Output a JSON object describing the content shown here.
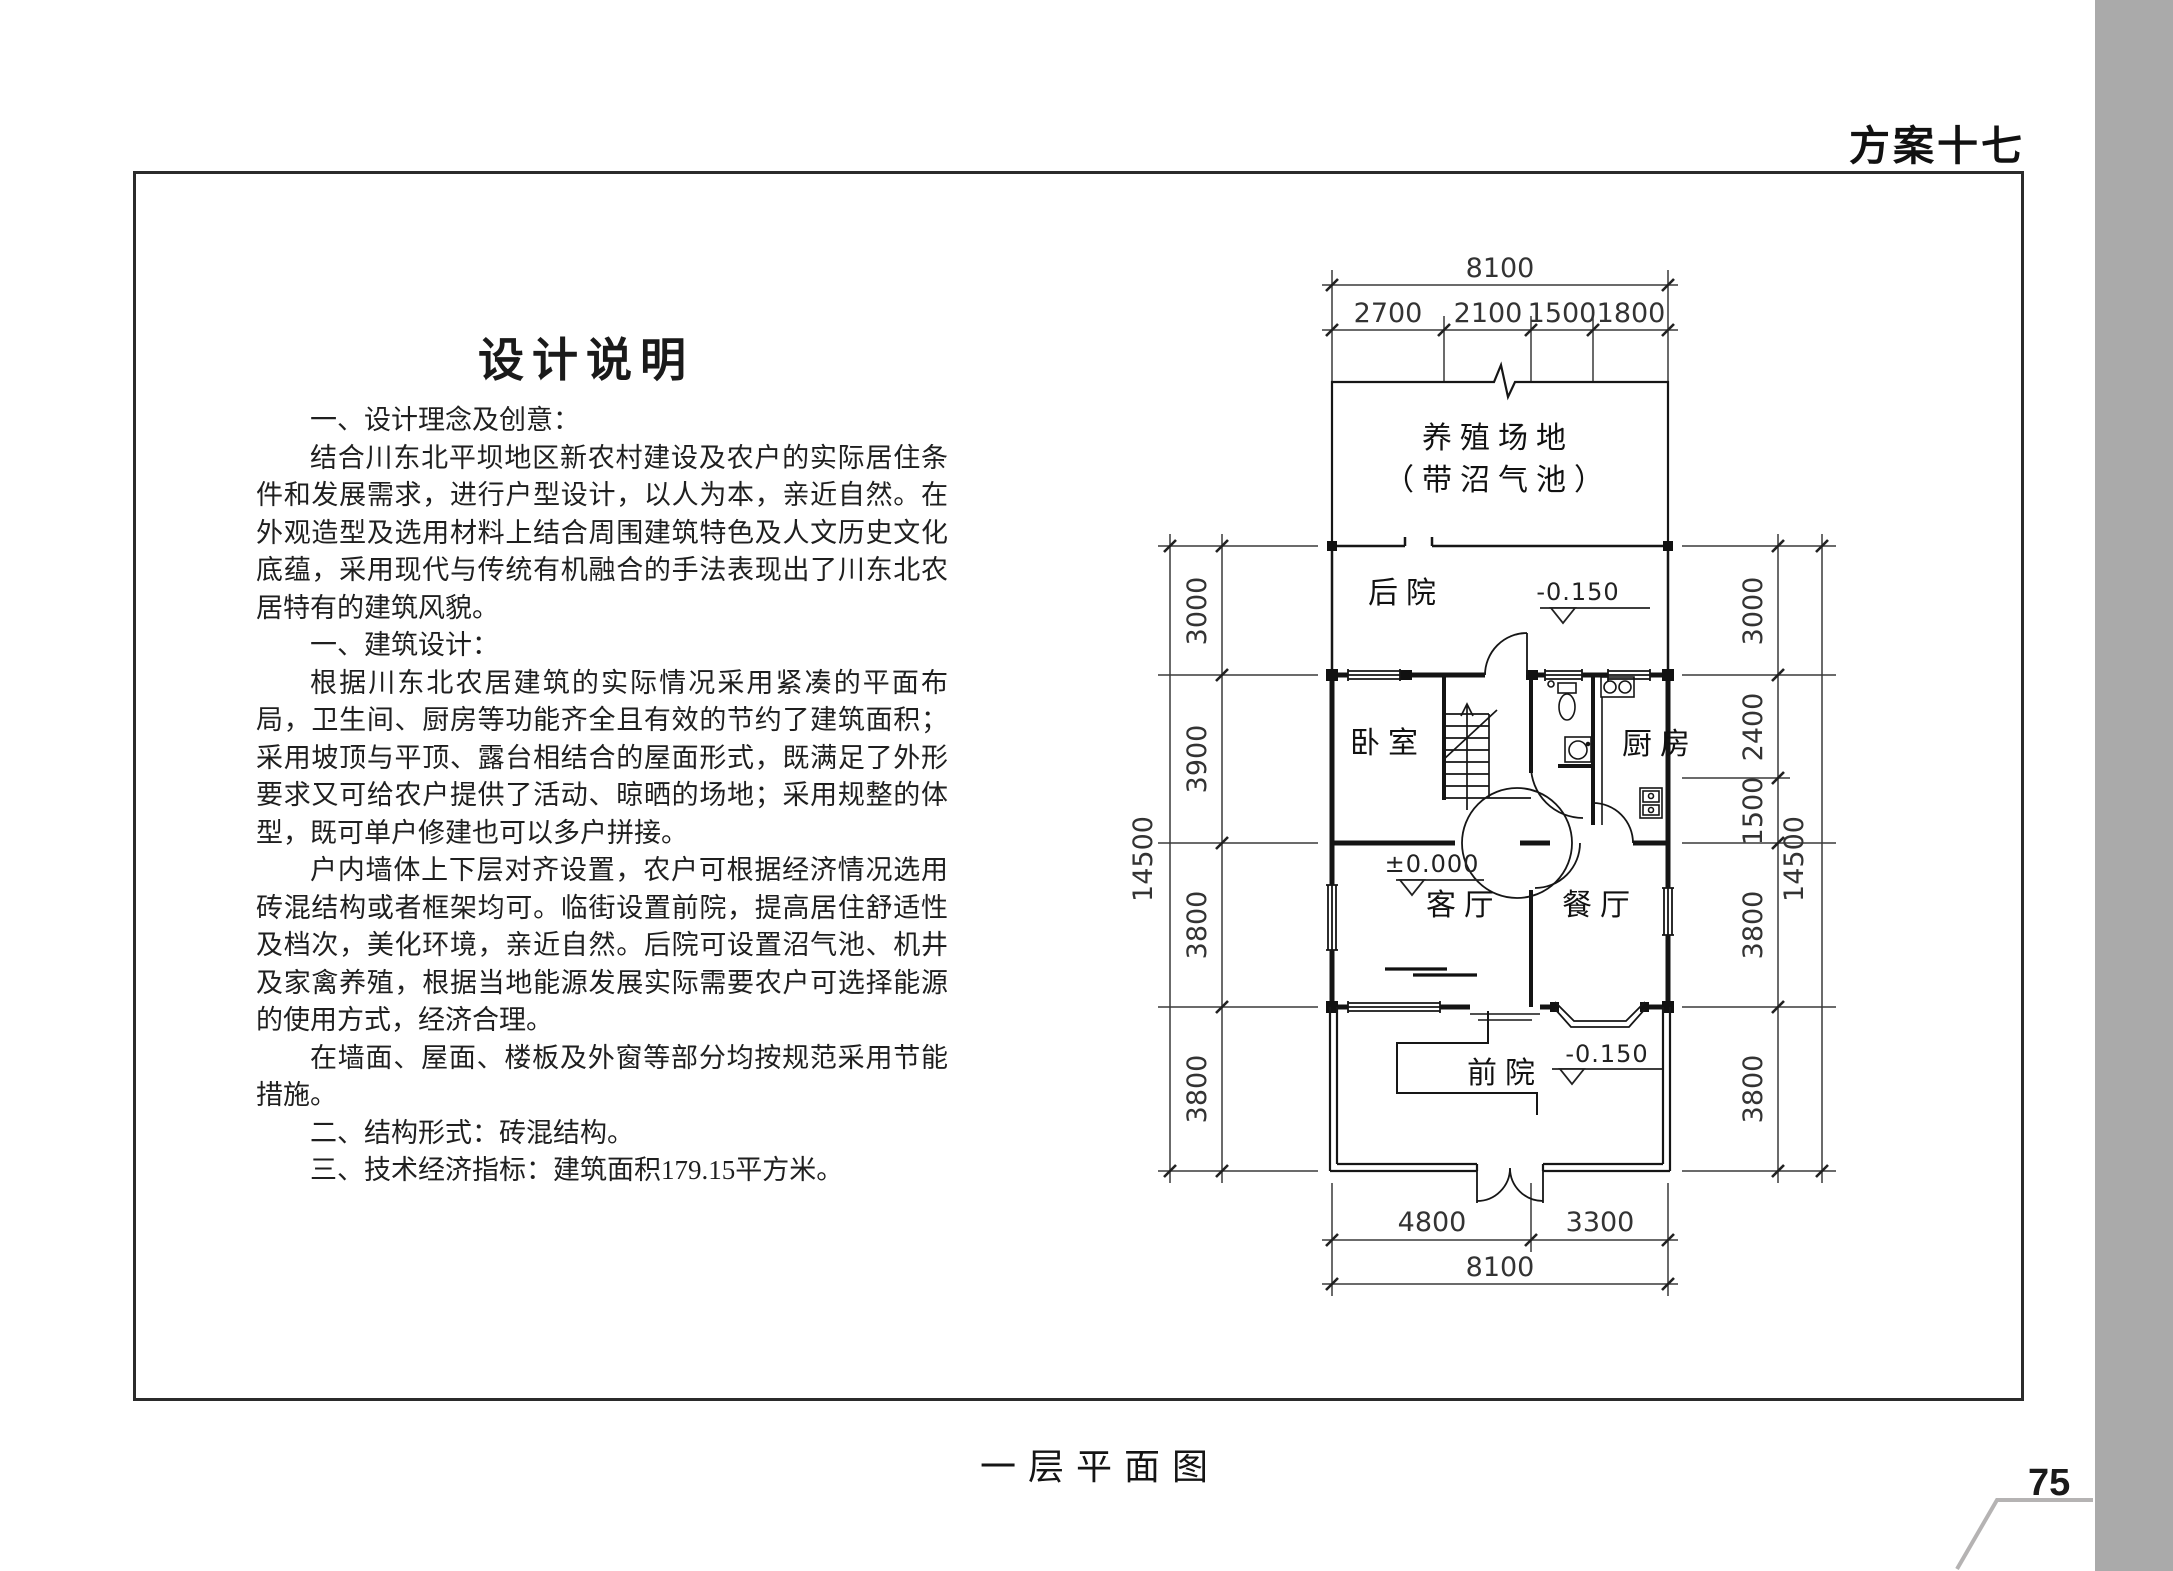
{
  "header": {
    "scheme_label": "方案十七"
  },
  "design_notes": {
    "title": "设计说明",
    "paragraphs": [
      "一、设计理念及创意：",
      "结合川东北平坝地区新农村建设及农户的实际居住条件和发展需求，进行户型设计，以人为本，亲近自然。在外观造型及选用材料上结合周围建筑特色及人文历史文化底蕴，采用现代与传统有机融合的手法表现出了川东北农居特有的建筑风貌。",
      "一、建筑设计：",
      "根据川东北农居建筑的实际情况采用紧凑的平面布局，卫生间、厨房等功能齐全且有效的节约了建筑面积；采用坡顶与平顶、露台相结合的屋面形式，既满足了外形要求又可给农户提供了活动、晾晒的场地；采用规整的体型，既可单户修建也可以多户拼接。",
      "户内墙体上下层对齐设置，农户可根据经济情况选用砖混结构或者框架均可。临街设置前院，提高居住舒适性及档次，美化环境，亲近自然。后院可设置沼气池、机井及家禽养殖，根据当地能源发展实际需要农户可选择能源的使用方式，经济合理。",
      "在墙面、屋面、楼板及外窗等部分均按规范采用节能措施。",
      "二、结构形式：砖混结构。",
      "三、技术经济指标：建筑面积179.15平方米。"
    ]
  },
  "floor_plan": {
    "caption": "一层平面图",
    "rooms": {
      "breeding_area": "养殖场地",
      "breeding_area_sub": "（带沼气池）",
      "backyard": "后院",
      "bedroom": "卧室",
      "kitchen": "厨房",
      "living_room": "客厅",
      "dining_room": "餐厅",
      "front_yard": "前院"
    },
    "levels": {
      "backyard": "-0.150",
      "living_room": "±0.000",
      "front_yard": "-0.150"
    },
    "dims": {
      "top_total": "8100",
      "top_segments": [
        "2700",
        "2100",
        "1500",
        "1800"
      ],
      "bottom_segments": [
        "4800",
        "3300"
      ],
      "bottom_total": "8100",
      "left_segments": [
        "3000",
        "3900",
        "3800",
        "3800"
      ],
      "left_total": "14500",
      "right_segments": [
        "3000",
        "2400",
        "1500",
        "3800",
        "3800"
      ],
      "right_total": "14500"
    }
  },
  "page": {
    "number": "75"
  }
}
